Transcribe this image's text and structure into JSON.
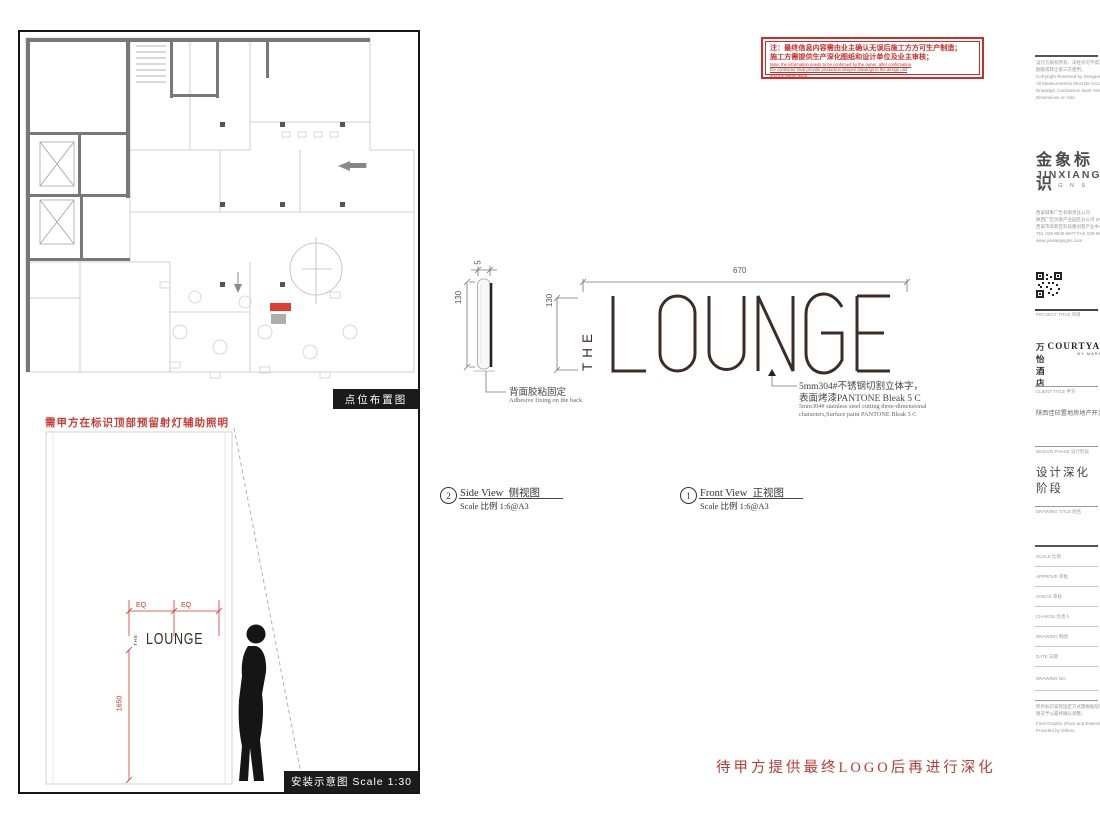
{
  "colors": {
    "accent_red": "#cf2b27",
    "dim_red": "#d23430",
    "logo_brown": "#3b2c25",
    "caption_bg": "#1b1b1b"
  },
  "note_box": {
    "line1": "注：最终信息内容需由业主确认无误后施工方方可生产制造；",
    "line2": "施工方需提供生产深化图纸和设计单位及业主审核；",
    "en1": "Note: the information needs to be confirmed by the owner, after confirmation",
    "en2": "the contractor shall provide production deepen drawings to the design unit",
    "en3": "and the owner audit."
  },
  "plan_panel": {
    "caption": "点位布置图",
    "entrance_label": "酒店入口"
  },
  "install_panel": {
    "red_note": "需甲方在标识顶部预留射灯辅助照明",
    "eq_left": "EQ",
    "eq_right": "EQ",
    "dim_height": "1650",
    "logo_the": "THE",
    "logo_main": "LOUNGE",
    "caption": "安装示意图  Scale 1:30"
  },
  "side_view": {
    "dim_thickness": "5",
    "dim_height": "130",
    "note_cn": "背面胶粘固定",
    "note_en": "Adhesive fixing on the back",
    "callout_no": "2",
    "title_en": "Side View",
    "title_cn": "侧视图",
    "scale": "Scale 比例 1:6@A3"
  },
  "front_view": {
    "dim_width": "670",
    "dim_height": "130",
    "logo_the": "THE",
    "logo_main": "LOUNGE",
    "note_cn1": "5mm304#不锈钢切割立体字，",
    "note_cn2": "表面烤漆PANTONE Bleak 5 C",
    "note_en1": "5mm304# stainless steel cutting three-dimensional",
    "note_en2": "characters,Surface paint PANTONE Bleak 5 C",
    "callout_no": "1",
    "title_en": "Front View",
    "title_cn": "正视图",
    "scale": "Scale 比例 1:6@A3"
  },
  "bottom_note": "待甲方提供最终LOGO后再进行深化",
  "title_block": {
    "copyright_lines": [
      "设计方版权所有，未经许可不得复制",
      "翻版或转让第三方使用。",
      "CoPyright Reserved by Designer",
      "All Measurements Must Be Accord to",
      "Drawings, Contractors Must Verify All",
      "Dimensions on Site."
    ],
    "brand_cn": "金象标识",
    "brand_en": "JINXIANG",
    "brand_sub": "S I G N S",
    "company_lines": [
      "西安城象广告有限责任公司",
      "陕西广告创意产业园区分公司 2F",
      "西安市高新区科技路创意产业中心大厦",
      "TEL 029-8845-6677  FAX 029-8845-6678",
      "www.jinxiangsigns.com"
    ],
    "project_label": "PROJECT TITLE 项目",
    "project_cn": "万怡酒店",
    "project_en": "COURTYARD",
    "project_sub": "BY MARRIOTT",
    "client_label": "CLIENT TITLE 甲方",
    "client_name": "陕西佳印置地房地产开发有限公司",
    "phase_label": "DESIGN PHASE 设计阶段",
    "phase_value": "设计深化阶段",
    "drawing_title_label": "DRAWING TITLE 图名",
    "fields": [
      {
        "label": "SCALE 比例"
      },
      {
        "label": "APPROVE 审批"
      },
      {
        "label": "CHECK 审核"
      },
      {
        "label": "CHARGE 负责人"
      },
      {
        "label": "DRAWING 制图"
      },
      {
        "label": "DATE 日期"
      },
      {
        "label": "DRAWING NO."
      }
    ],
    "footer_cn1": "所有标识安装固定方式需根据现场实际",
    "footer_cn2": "情况予以最终确认调整。",
    "footer_en1": "Final Graphic (Face and Extension) to be",
    "footer_en2": "Provided by Others."
  }
}
